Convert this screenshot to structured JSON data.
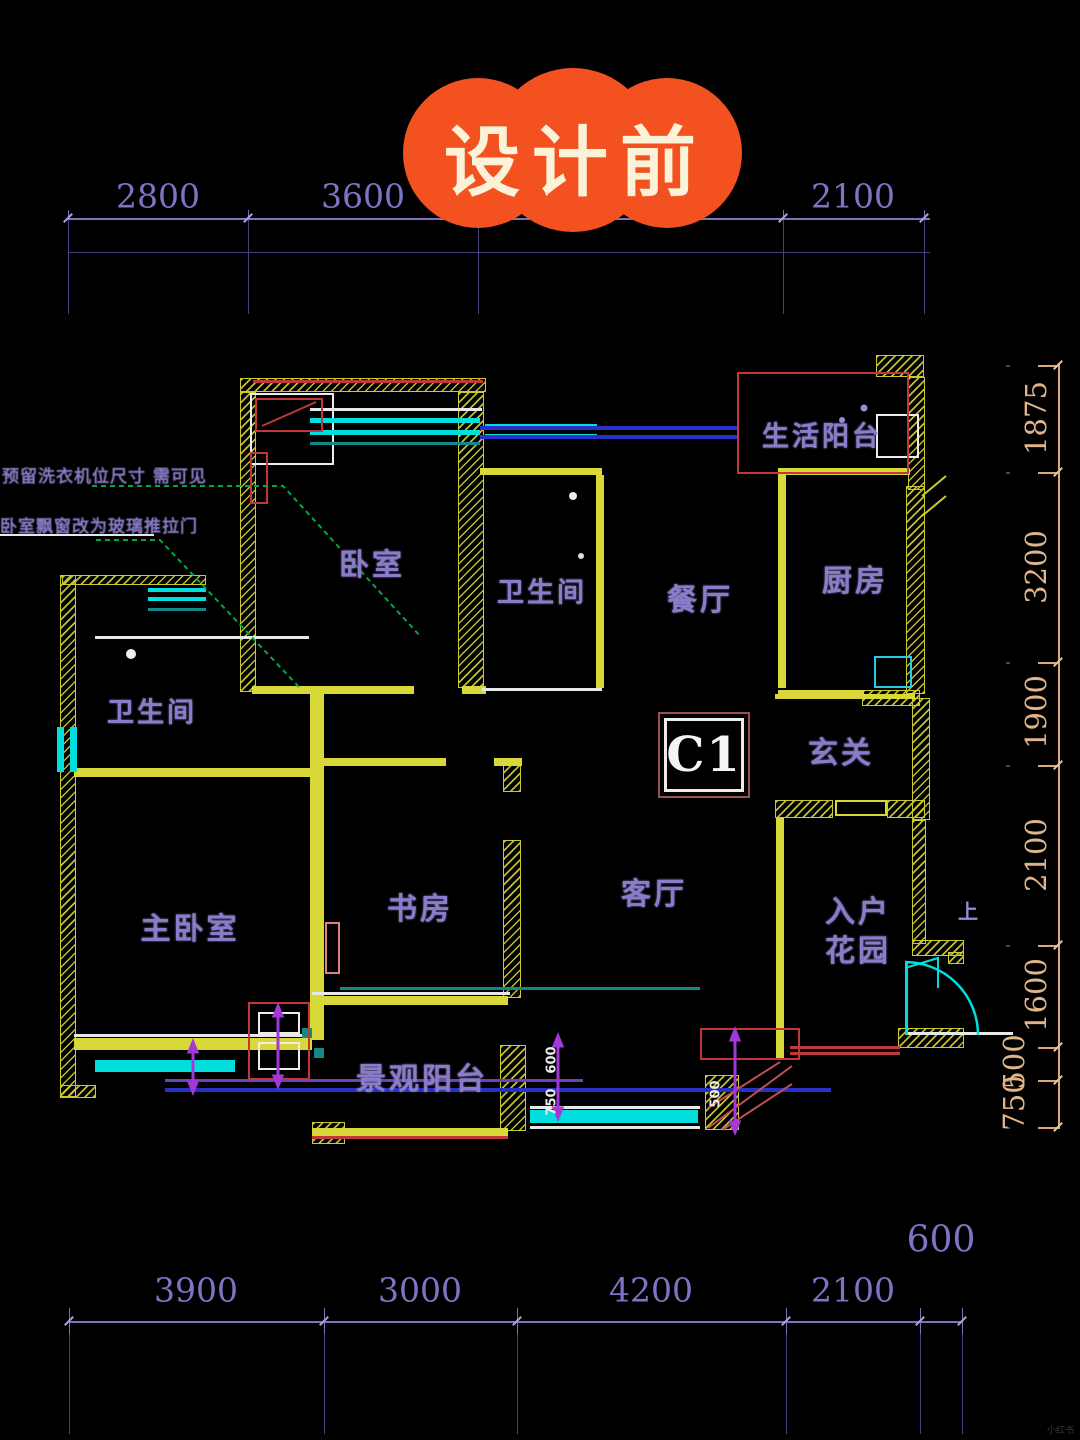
{
  "badge": {
    "label": "设计前",
    "bg_color": "#f3511f",
    "text_color": "#fbf2d8"
  },
  "unit": {
    "code": "C1",
    "direction_marker": "上"
  },
  "rooms": [
    {
      "id": "bedroom",
      "label": "卧室"
    },
    {
      "id": "bath-top",
      "label": "卫生间"
    },
    {
      "id": "dining",
      "label": "餐厅"
    },
    {
      "id": "kitchen",
      "label": "厨房"
    },
    {
      "id": "life-balcony",
      "label": "生活阳台"
    },
    {
      "id": "hallway",
      "label": "玄关"
    },
    {
      "id": "living",
      "label": "客厅"
    },
    {
      "id": "study",
      "label": "书房"
    },
    {
      "id": "master-bedroom",
      "label": "主卧室"
    },
    {
      "id": "bath-left",
      "label": "卫生间"
    },
    {
      "id": "entry-garden",
      "label": "入户花园"
    },
    {
      "id": "view-balcony",
      "label": "景观阳台"
    }
  ],
  "annotations": {
    "line1": "预留洗衣机位尺寸 需可见",
    "line2": "卧室飘窗改为玻璃推拉门"
  },
  "dimensions": {
    "top": [
      "2800",
      "3600",
      "4800",
      "2100"
    ],
    "bottom": [
      "3900",
      "3000",
      "4200",
      "2100",
      "600"
    ],
    "right": [
      "1875",
      "3200",
      "1900",
      "2100",
      "1600",
      "500",
      "750"
    ],
    "mini": [
      "600",
      "750",
      "500"
    ]
  },
  "colors": {
    "wall_yellow": "#d8d838",
    "window_cyan": "#00dede",
    "dim_purple": "#7d74c4",
    "dim_tan": "#e0b488",
    "label_purple": "#8a7cc8",
    "line_blue": "#2830c8",
    "line_red": "#c03838",
    "line_green": "#00a844",
    "arrow_magenta": "#a238d8",
    "badge_orange": "#f3511f"
  },
  "watermark": "小红书"
}
